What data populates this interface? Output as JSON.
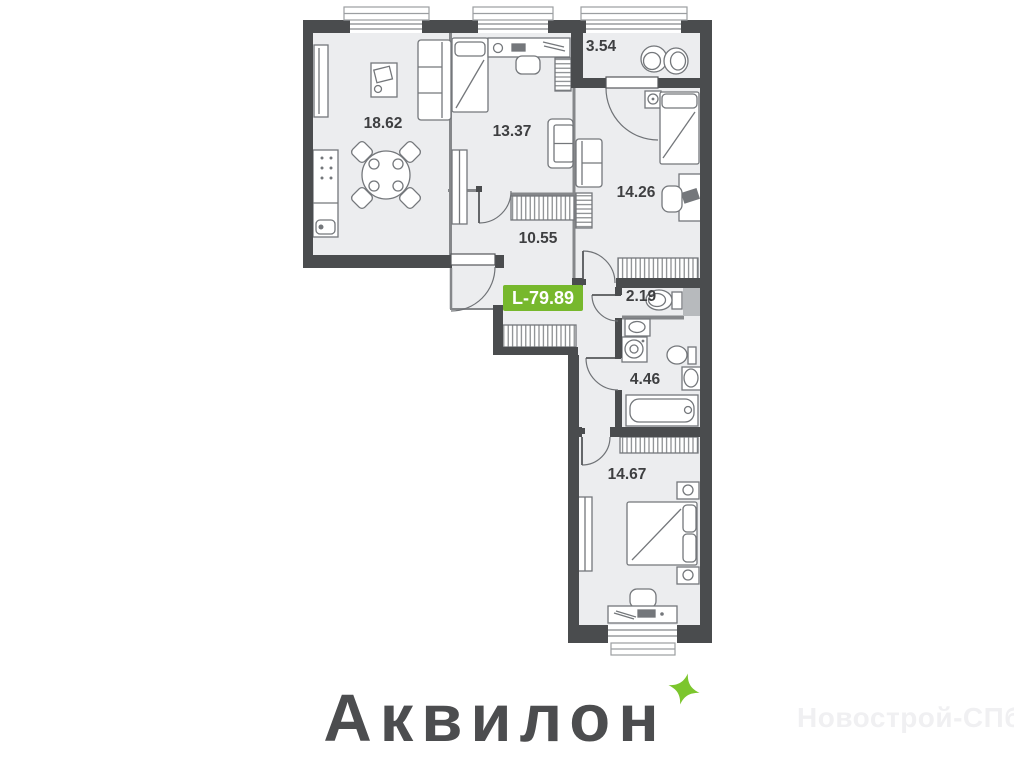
{
  "floor_plan": {
    "area_badge": {
      "label": "L-79.89",
      "background_color": "#77b82d",
      "text_color": "#ffffff"
    },
    "rooms": [
      {
        "name": "kitchen-living-room",
        "area": "18.62"
      },
      {
        "name": "bedroom-top",
        "area": "13.37"
      },
      {
        "name": "ensuite-bathroom",
        "area": "3.54"
      },
      {
        "name": "bedroom-right",
        "area": "14.26"
      },
      {
        "name": "hallway",
        "area": "10.55"
      },
      {
        "name": "wc",
        "area": "2.19"
      },
      {
        "name": "bathroom",
        "area": "4.46"
      },
      {
        "name": "bedroom-bottom",
        "area": "14.67"
      }
    ],
    "wall_color": "#4a4c4e",
    "floor_color": "#ecedef"
  },
  "branding": {
    "logo_text": "Аквилон",
    "logo_color": "#4c4d4f",
    "sparkle_color": "#7cc62d"
  },
  "watermark": {
    "text": "Новострой-СПб",
    "color": "#f0f0f2"
  }
}
